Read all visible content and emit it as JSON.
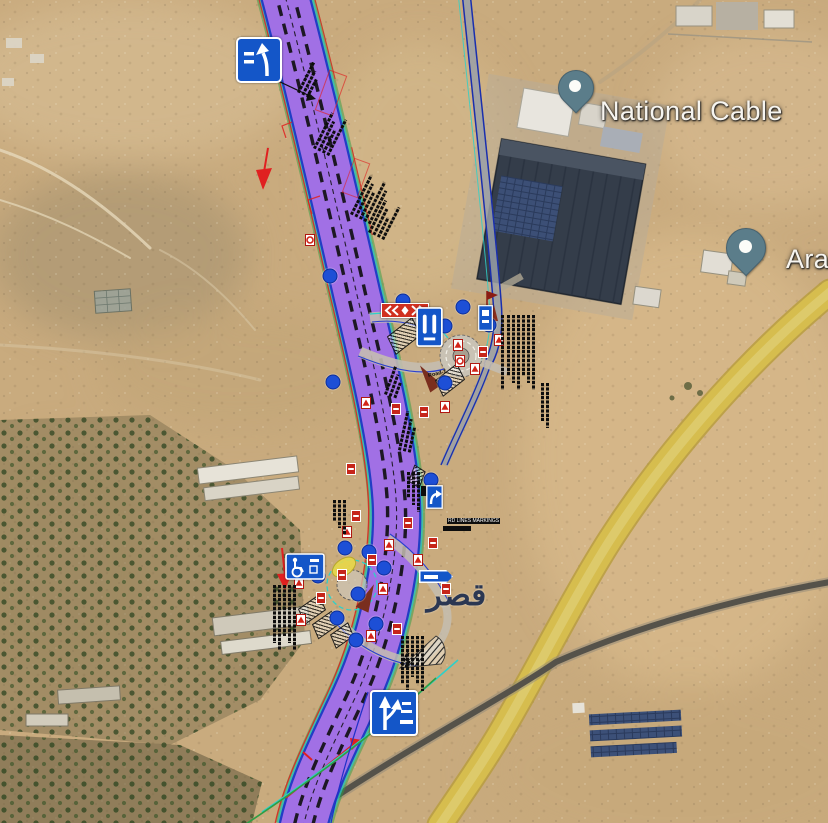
{
  "place_labels": {
    "national_cable": "National Cable",
    "ara_partial": "Ara",
    "arabic_place": "قصر",
    "road_label": "Road-1",
    "markings_note": "RD LINES MARKINGS"
  },
  "overlay_colors": {
    "corridor_fill": "#b678e6",
    "corridor_edge": "#2030c8",
    "survey_teal": "#2fd0c8",
    "survey_green": "#2f9e44",
    "dimension_red": "#e02020",
    "utility_marker_blue": "#1d4fd6",
    "sign_blue": "#1456c8",
    "sign_red": "#d03020",
    "existing_road_yellow": "#d6bd4e",
    "poi_pin_gray": "#5b7d8a"
  },
  "sign_names": [
    "lane-shift-guide-sign",
    "double-chevron-sign",
    "narrow-lanes-sign",
    "accessible-parking-sign",
    "lane-split-guide-sign",
    "direction-arrow-sign",
    "mini-guide-arrow-sign",
    "small-blue-regulatory-sign"
  ]
}
